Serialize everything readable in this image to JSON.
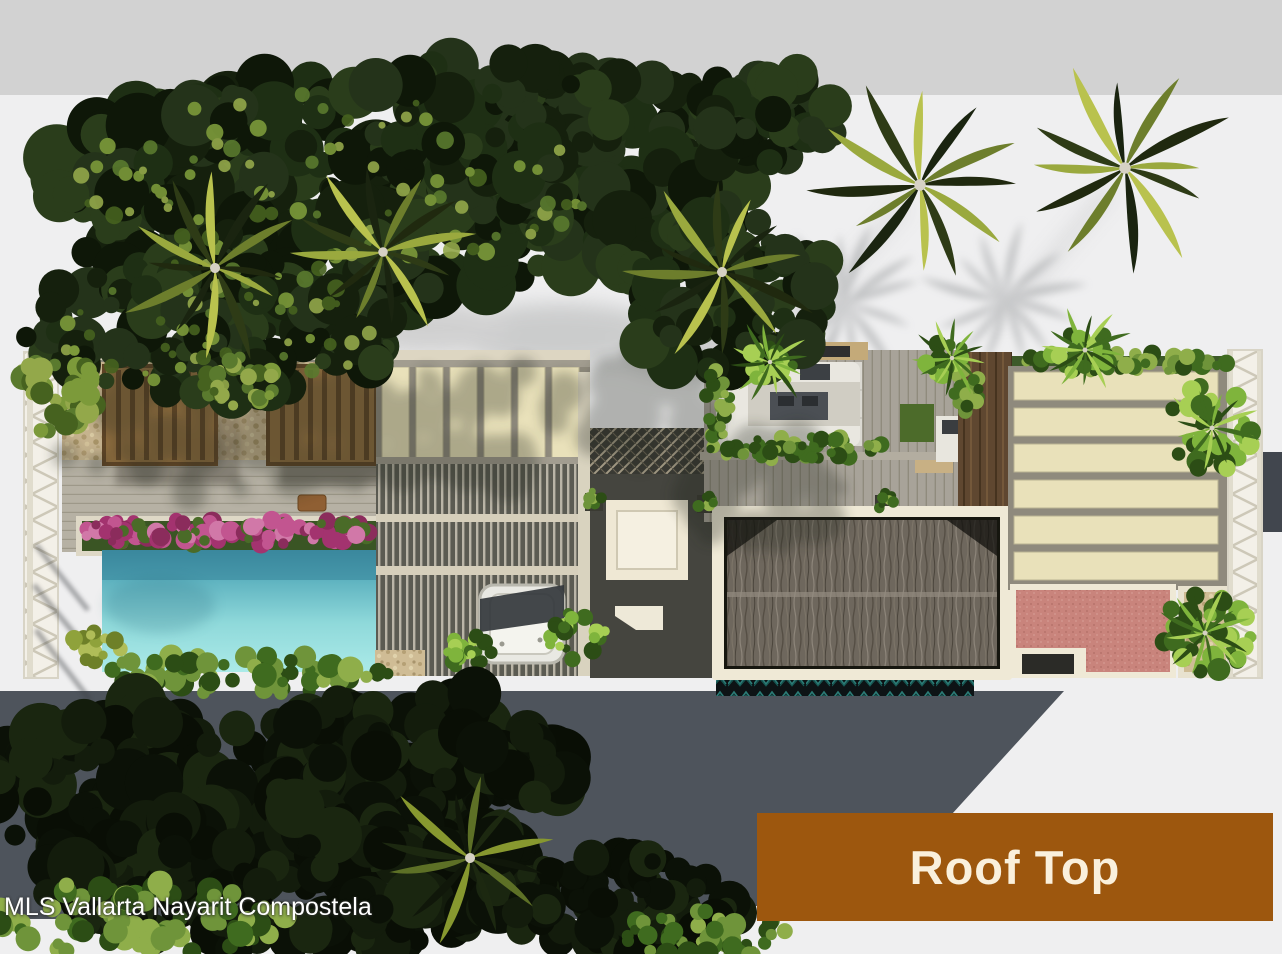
{
  "page": {
    "kind": "architectural-aerial-rendering",
    "subject": "rooftop plan 3D render with pool, palapa roof, pergolas and palm trees"
  },
  "banner": {
    "label": "Roof Top",
    "background": "#9d570e",
    "text_color": "#faf0dc"
  },
  "watermark": {
    "text": "MLS Vallarta Nayarit Compostela",
    "color": "#ffffff"
  },
  "colors": {
    "top_bar": "#d2d2d2",
    "canvas_background": "#efeff0",
    "street_shadow": "#4e545c",
    "pool_water_deep": "#3f8ba0",
    "pool_water_shallow": "#abeae8",
    "thatch_roof": "#6b6359",
    "louver_beige": "#e9e1ba",
    "terrace_pink": "#c8837b",
    "stone_patio": "#c6b38e",
    "pergola_wood": "#8d6c3e",
    "bougainvillea_pink": "#b64583",
    "foliage_dark": "#1c2a12",
    "foliage_bright": "#7fb43c",
    "trellis_white": "#f3f0e8"
  }
}
